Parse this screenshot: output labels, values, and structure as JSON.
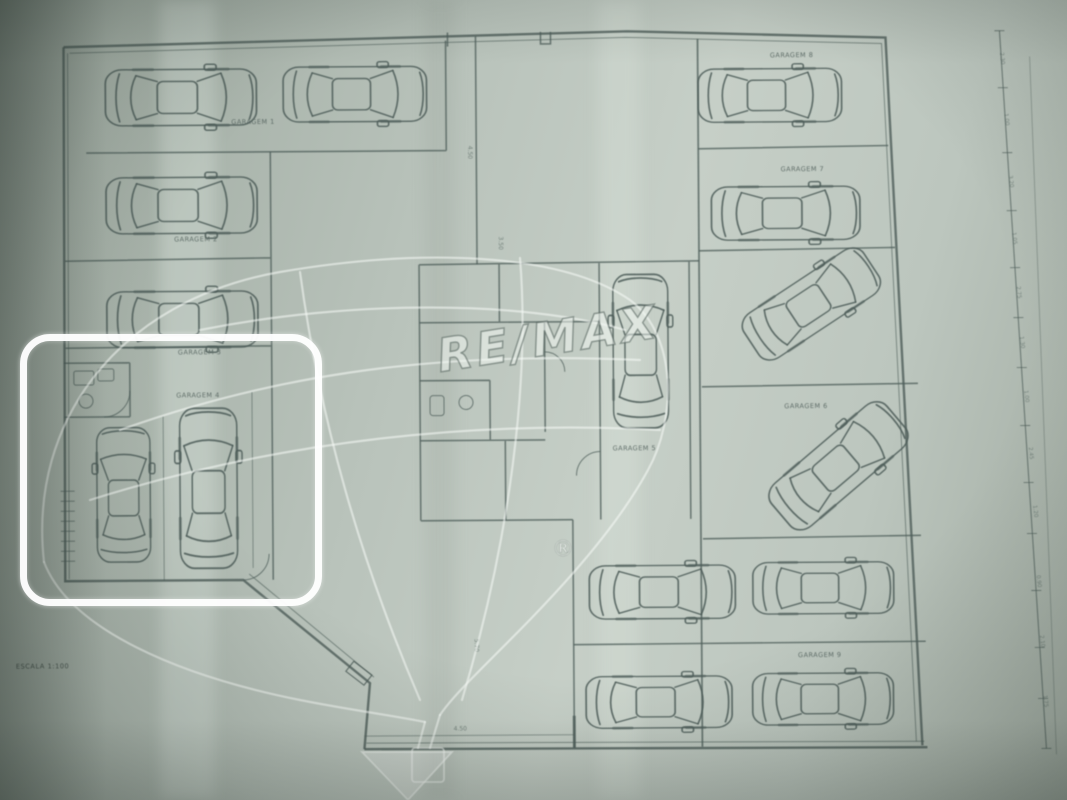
{
  "watermark": {
    "brand": "RE/MAX",
    "registered": "®"
  },
  "garages": [
    {
      "label": "GARAGEM 1"
    },
    {
      "label": "GARAGEM 2"
    },
    {
      "label": "GARAGEM 3"
    },
    {
      "label": "GARAGEM 4"
    },
    {
      "label": "GARAGEM 5"
    },
    {
      "label": "GARAGEM 6"
    },
    {
      "label": "GARAGEM 7"
    },
    {
      "label": "GARAGEM 8"
    },
    {
      "label": "GARAGEM 9"
    }
  ],
  "scale_note": "ESCALA 1:100",
  "dims": [
    "4.50",
    "3.50",
    "5.70",
    "4.50"
  ],
  "ruler_values": [
    "2.30",
    "1.00",
    "3.20",
    "1.05",
    "2.75",
    "1.30",
    "1.00",
    "2.45",
    "1.20",
    "0.90",
    "2.10",
    "1.75"
  ],
  "colors": {
    "paper": "#b9c3bb",
    "ink": "#4d5d59",
    "highlight": "#ffffff"
  }
}
